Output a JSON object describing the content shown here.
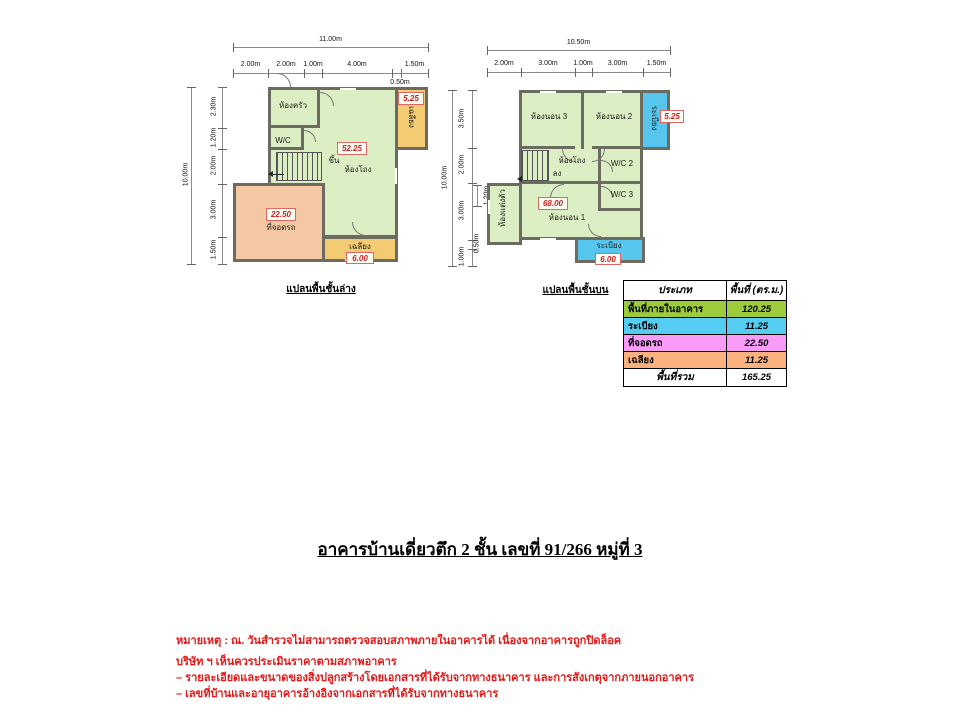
{
  "ground_floor": {
    "caption": "แปลนพื้นชั้นล่าง",
    "total_width": "11.00m",
    "total_height": "10.00m",
    "dims_top": [
      "2.00m",
      "2.00m",
      "1.00m",
      "4.00m",
      "1.50m"
    ],
    "dim_top_sub": "0.50m",
    "dims_left": [
      "2.30m",
      "1.20m",
      "2.00m",
      "3.00m",
      "1.50m"
    ],
    "rooms": {
      "kitchen": "ห้องครัว",
      "wc": "W/C",
      "stairs_up": "ขึ้น",
      "hall": "ห้องโถง",
      "hall_area": "52.25",
      "carport": "ที่จอดรถ",
      "carport_area": "22.50",
      "porch_bottom": "เฉลียง",
      "porch_bottom_area": "6.00",
      "porch_right": "เฉลียง",
      "porch_right_area": "5.25"
    }
  },
  "upper_floor": {
    "caption": "แปลนพื้นชั้นบน",
    "total_width": "10.50m",
    "total_height": "10.00m",
    "dims_top": [
      "2.00m",
      "3.00m",
      "1.00m",
      "3.00m",
      "1.50m"
    ],
    "dims_left": [
      "3.50m",
      "2.00m",
      "3.00m",
      "1.00m"
    ],
    "dim_left_sub1": "1.20m",
    "dim_left_sub2": "0.50m",
    "rooms": {
      "bedroom3": "ห้องนอน 3",
      "bedroom2": "ห้องนอน 2",
      "balcony_right": "ระเบียง",
      "balcony_right_area": "5.25",
      "hall": "ห้องโถง",
      "stairs_down": "ลง",
      "wc2": "W/C 2",
      "wc3": "W/C 3",
      "bedroom1": "ห้องนอน 1",
      "bedroom1_area": "68.00",
      "dressing": "ห้องแต่งตัว",
      "balcony_bottom": "ระเบียง",
      "balcony_bottom_area": "6.00"
    }
  },
  "area_table": {
    "headers": [
      "ประเภท",
      "พื้นที่ (ตร.ม.)"
    ],
    "rows": [
      {
        "label": "พื้นที่ภายในอาคาร",
        "value": "120.25",
        "color": "#9CCB3B"
      },
      {
        "label": "ระเบียง",
        "value": "11.25",
        "color": "#55CCF2"
      },
      {
        "label": "ที่จอดรถ",
        "value": "22.50",
        "color": "#FA9BFA"
      },
      {
        "label": "เฉลียง",
        "value": "11.25",
        "color": "#FBB27E"
      }
    ],
    "footer": {
      "label": "พื้นที่รวม",
      "value": "165.25"
    }
  },
  "title": "อาคารบ้านเดี่ยวตึก 2 ชั้น เลขที่ 91/266 หมู่ที่ 3",
  "notes": [
    "หมายเหตุ : ณ. วันสำรวจไม่สามารถตรวจสอบสภาพภายในอาคารได้ เนื่องจากอาคารถูกปิดล็อค",
    "บริษัท ฯ เห็นควรประเมินราคาตามสภาพอาคาร",
    "– รายละเอียดและขนาดของสิ่งปลูกสร้างโดยเอกสารที่ได้รับจากทางธนาคาร และการสังเกตุจากภายนอกอาคาร",
    "– เลขที่บ้านและอายุอาคารอ้างอิงจากเอกสารที่ได้รับจากทางธนาคาร"
  ],
  "colors": {
    "interior": "#DCEEC3",
    "wall": "#6B6B5F",
    "carport": "#F3C8A3",
    "porch": "#F2CB72",
    "balcony": "#57C6EF",
    "area_value_red": "#CC2222",
    "notes_red": "#E51717"
  }
}
